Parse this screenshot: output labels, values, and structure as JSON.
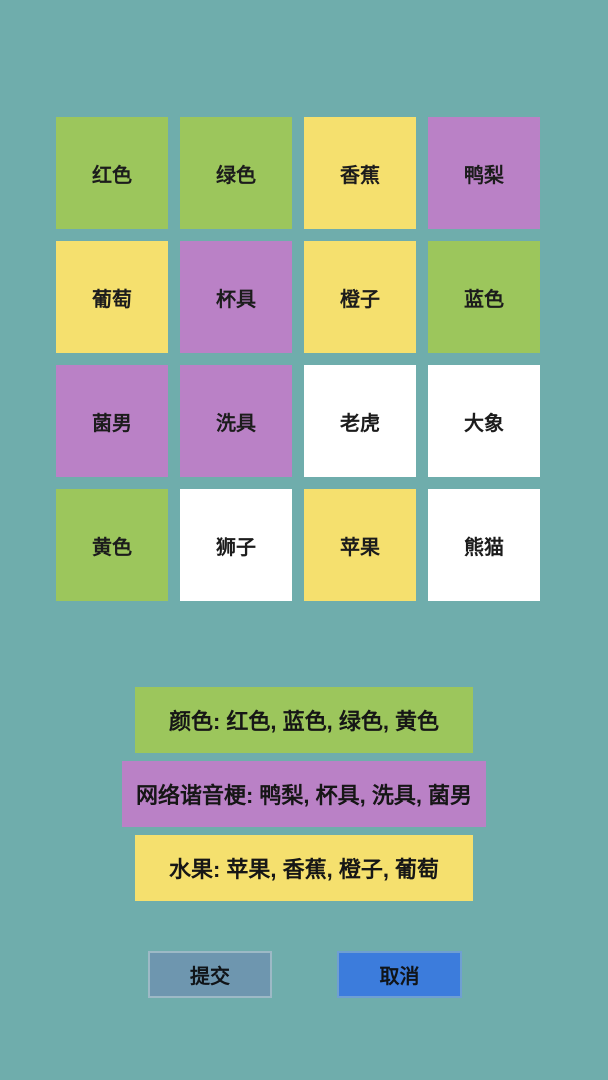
{
  "colors": {
    "background": "#6FADAC",
    "green": "#9CC65C",
    "yellow": "#F5E06E",
    "purple": "#BA81C6",
    "white": "#FFFFFF",
    "submit_bg": "#6E96AF",
    "cancel_bg": "#3C7CDC"
  },
  "grid": {
    "tiles": [
      {
        "label": "红色",
        "color": "green"
      },
      {
        "label": "绿色",
        "color": "green"
      },
      {
        "label": "香蕉",
        "color": "yellow"
      },
      {
        "label": "鸭梨",
        "color": "purple"
      },
      {
        "label": "葡萄",
        "color": "yellow"
      },
      {
        "label": "杯具",
        "color": "purple"
      },
      {
        "label": "橙子",
        "color": "yellow"
      },
      {
        "label": "蓝色",
        "color": "green"
      },
      {
        "label": "菌男",
        "color": "purple"
      },
      {
        "label": "洗具",
        "color": "purple"
      },
      {
        "label": "老虎",
        "color": "white"
      },
      {
        "label": "大象",
        "color": "white"
      },
      {
        "label": "黄色",
        "color": "green"
      },
      {
        "label": "狮子",
        "color": "white"
      },
      {
        "label": "苹果",
        "color": "yellow"
      },
      {
        "label": "熊猫",
        "color": "white"
      }
    ]
  },
  "solved_groups": [
    {
      "label": "颜色: 红色, 蓝色, 绿色, 黄色",
      "color": "green"
    },
    {
      "label": "网络谐音梗: 鸭梨, 杯具, 洗具, 菌男",
      "color": "purple"
    },
    {
      "label": "水果: 苹果, 香蕉, 橙子, 葡萄",
      "color": "yellow"
    }
  ],
  "buttons": {
    "submit": "提交",
    "cancel": "取消"
  }
}
